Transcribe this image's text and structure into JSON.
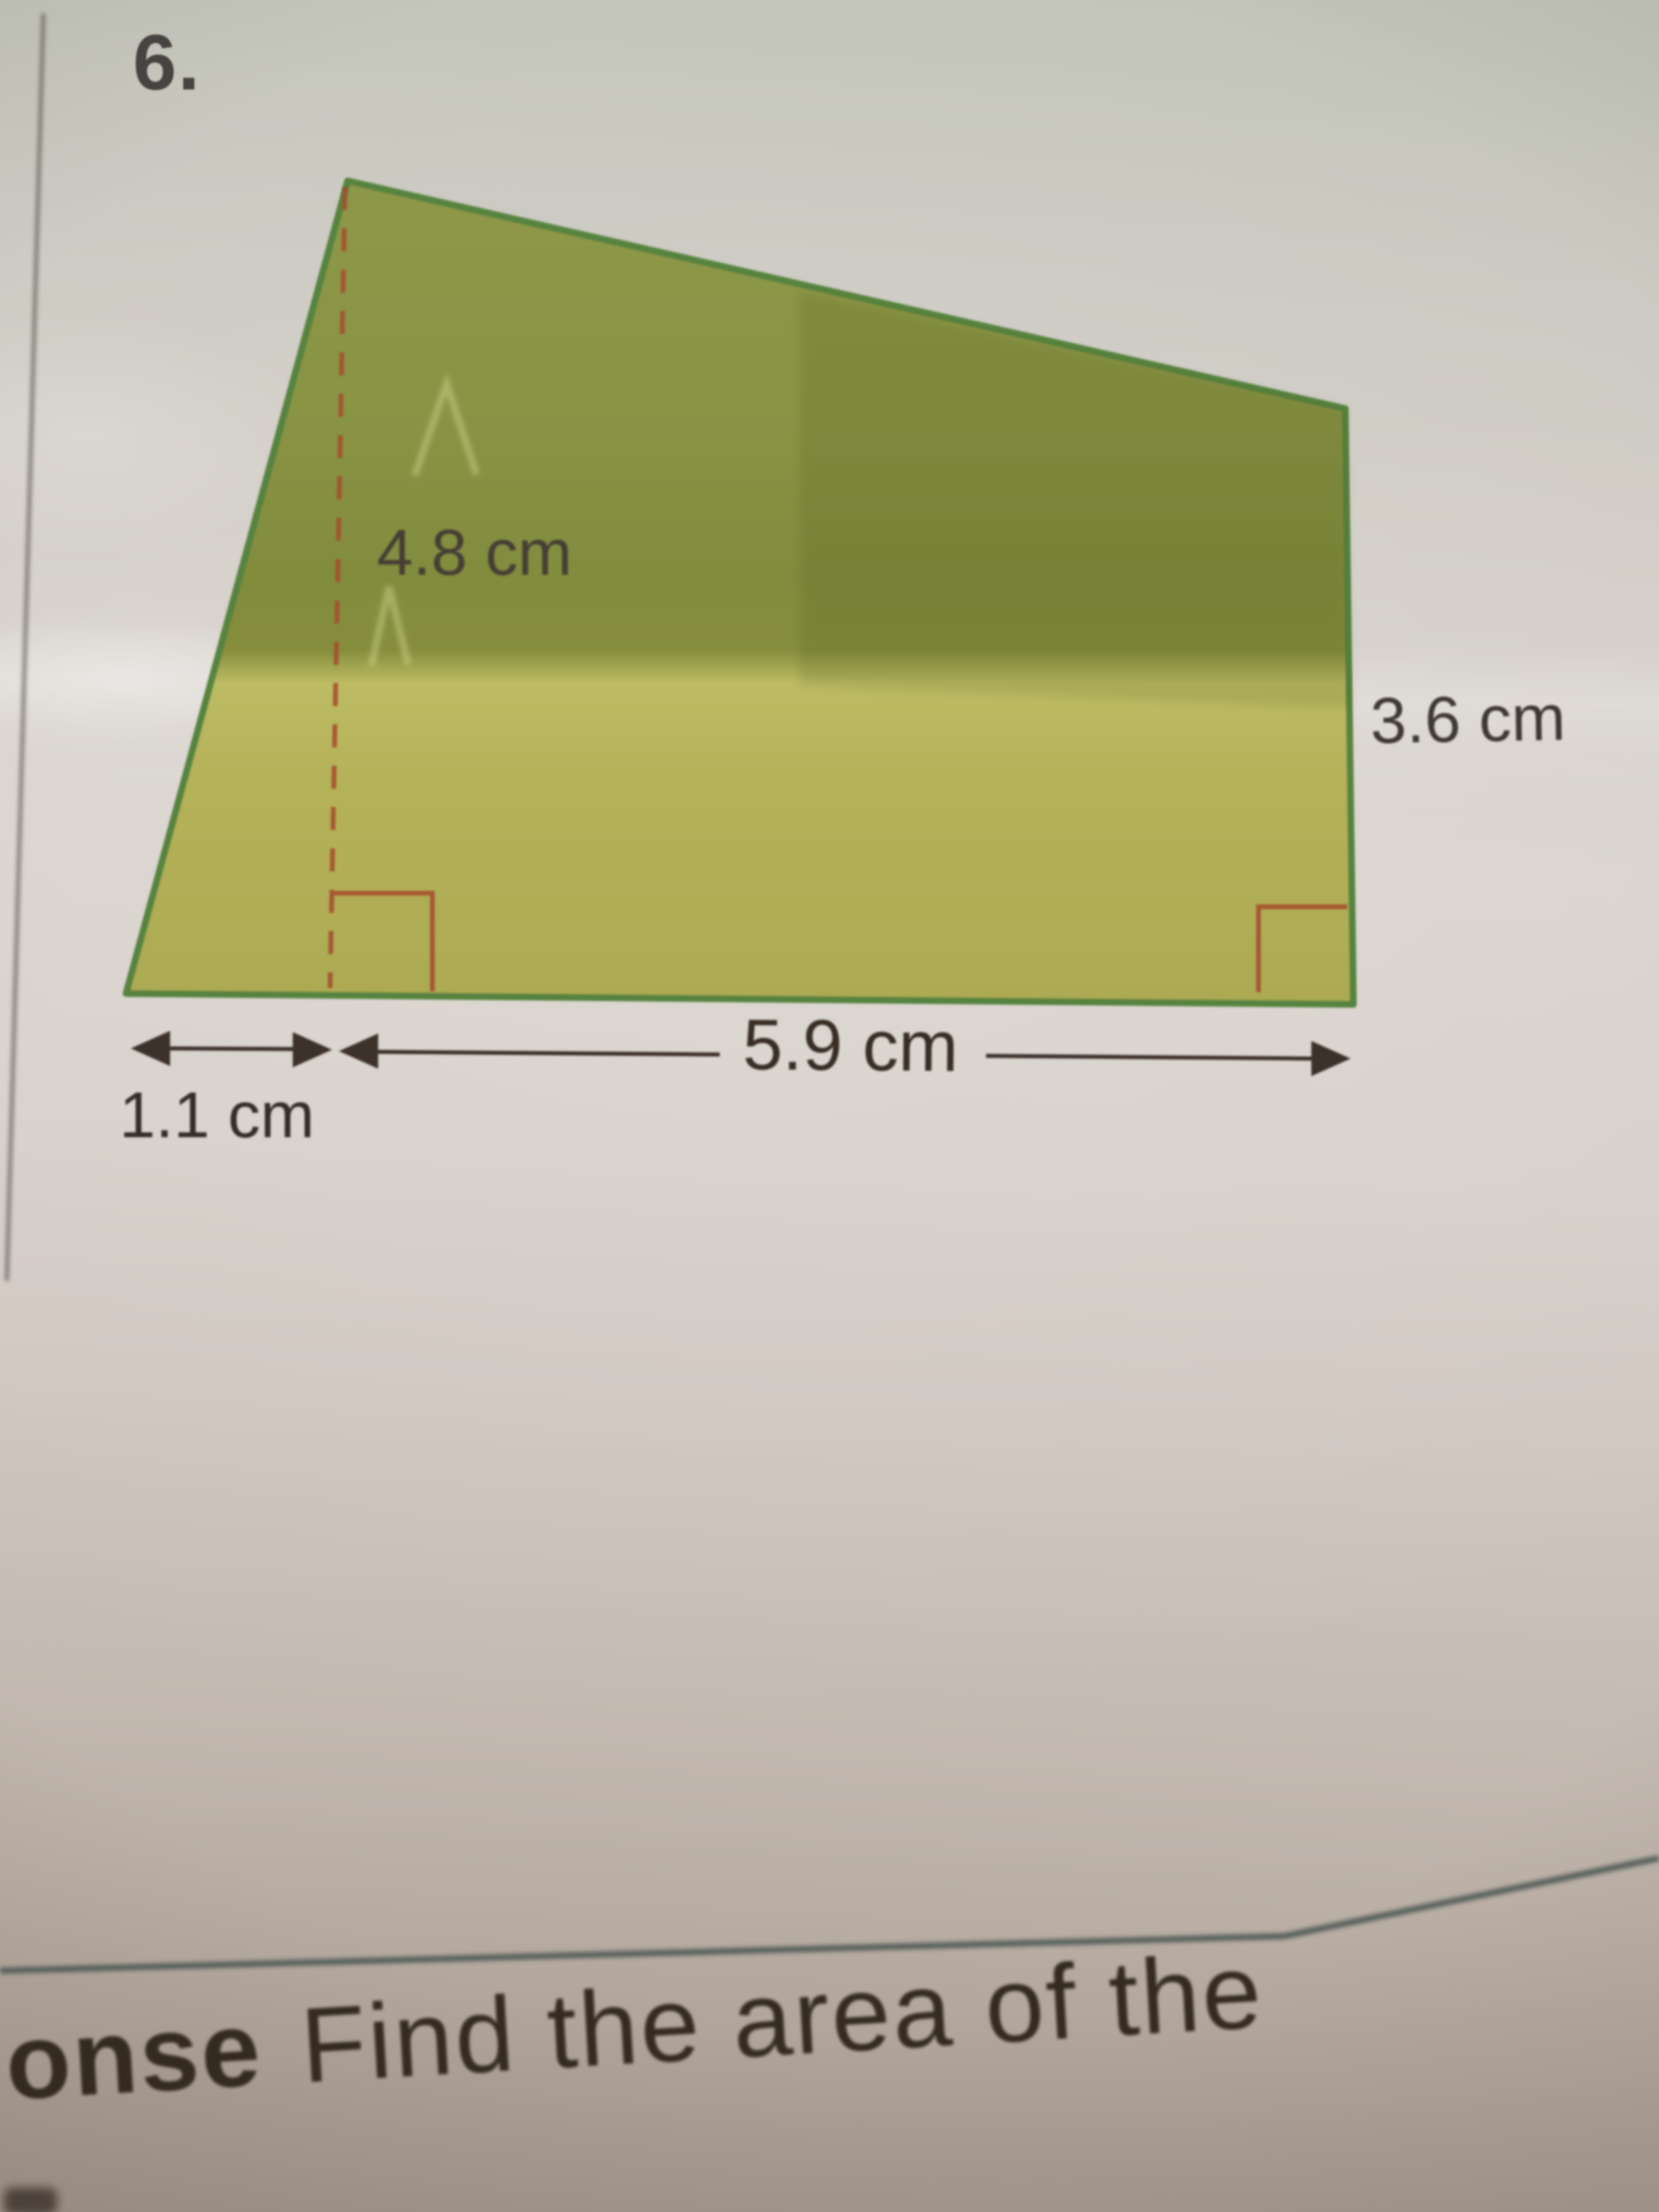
{
  "problem": {
    "number": "6.",
    "figure": {
      "shape": "quadrilateral",
      "measurements": {
        "height": "4.8 cm",
        "right_side": "3.6 cm",
        "base": "5.9 cm",
        "base_left_offset": "1.1 cm"
      }
    }
  },
  "prompt": {
    "cutoff_word_fragment": "onse",
    "question_fragment": "Find the area of the"
  },
  "colors": {
    "figure_fill": "#a9ab52",
    "figure_outline": "#57833f",
    "annotation_red": "#a5502e",
    "dimension_line": "#3c332b",
    "divider_line": "#485551"
  }
}
